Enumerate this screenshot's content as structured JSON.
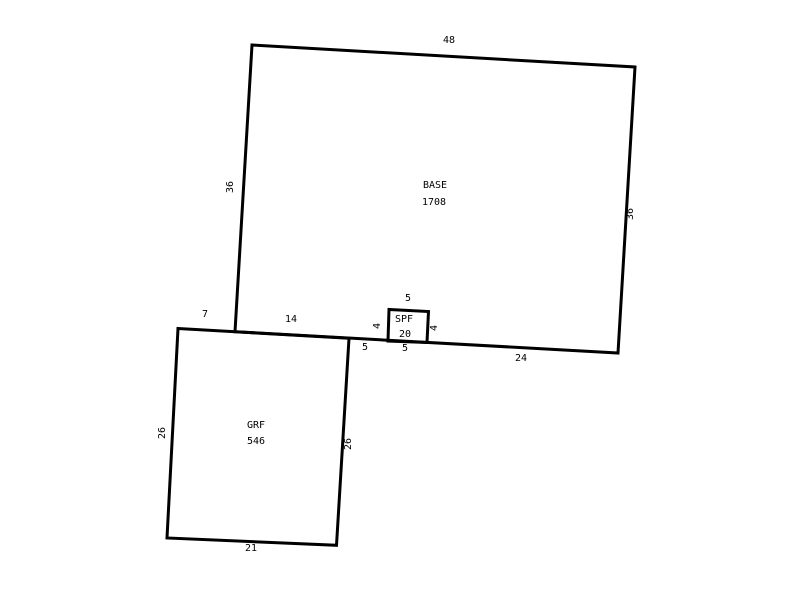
{
  "canvas": {
    "background": "#ffffff",
    "line_color": "#000000"
  },
  "shapes": {
    "base": {
      "name": "BASE",
      "area": "1708",
      "dim_top": "48",
      "dim_left": "36",
      "dim_right": "36",
      "dim_bottom_left": "14",
      "dim_bottom_mid": "5",
      "dim_bottom_right": "24"
    },
    "spf": {
      "name": "SPF",
      "area": "20",
      "dim_top": "5",
      "dim_left": "4",
      "dim_right": "4",
      "dim_bottom": "5"
    },
    "grf": {
      "name": "GRF",
      "area": "546",
      "dim_top": "7",
      "dim_left": "26",
      "dim_right": "26",
      "dim_bottom": "21"
    }
  }
}
